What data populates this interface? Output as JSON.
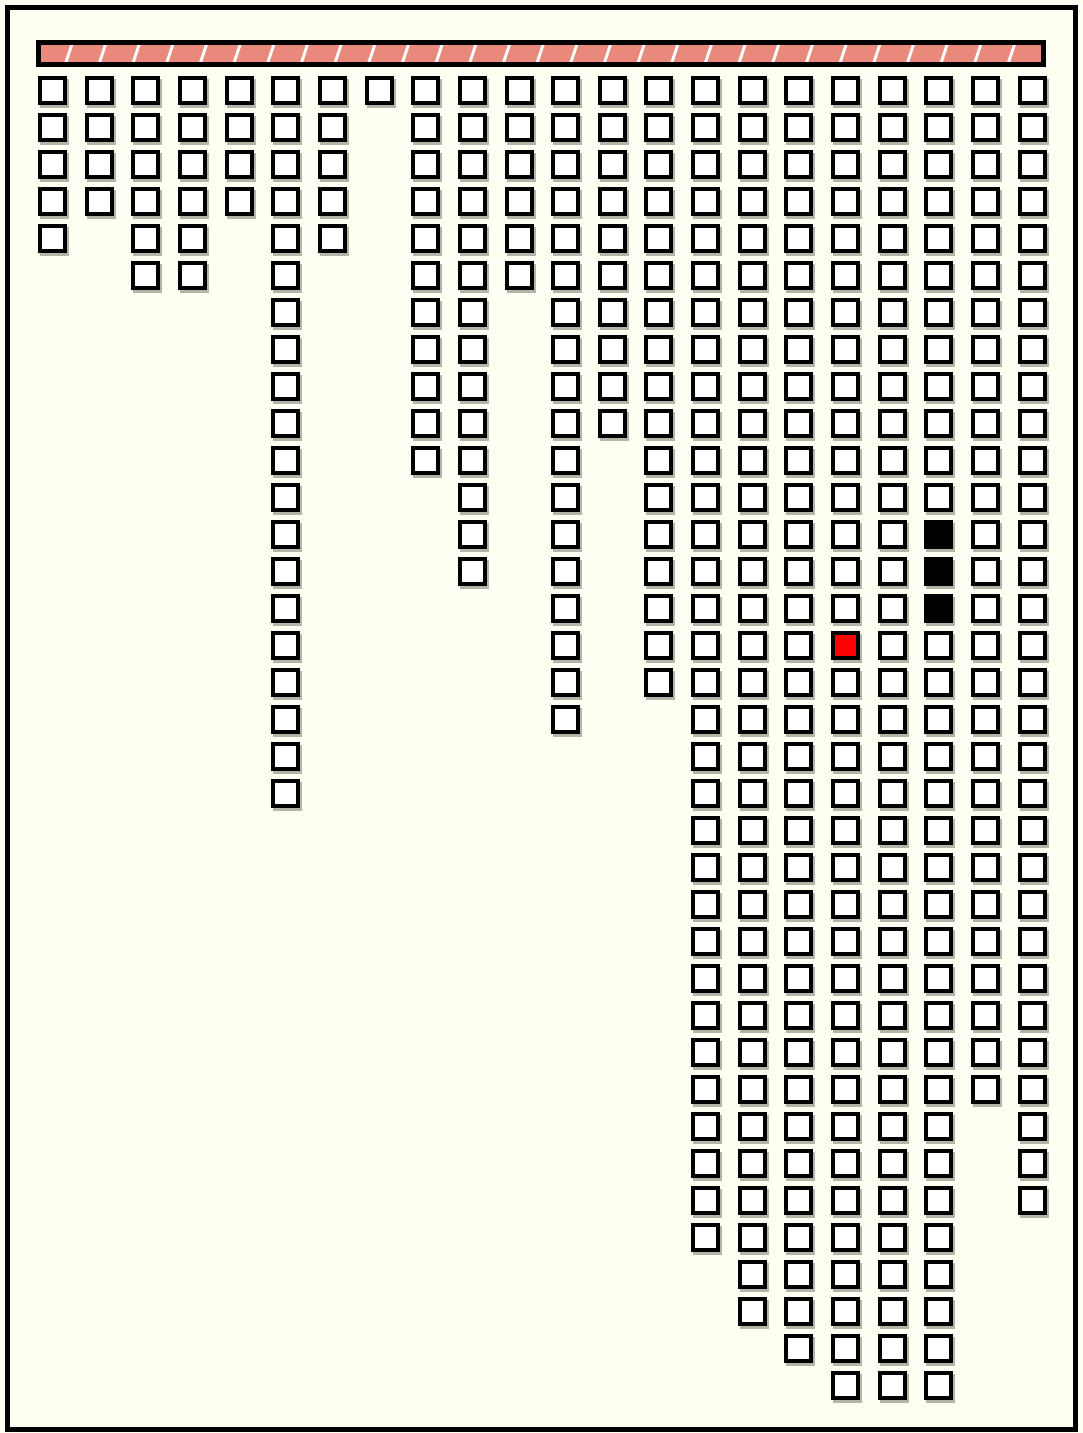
{
  "figure": {
    "kind": "hanging-chains-diagram",
    "width_px": 1083,
    "height_px": 1433,
    "background_color": "#FFFEF2",
    "frame_color": "#000000",
    "frame_inset_px": 5,
    "frame_thickness_px": 5
  },
  "support_bar": {
    "x": 36,
    "y": 40,
    "width": 1010,
    "height": 27,
    "fill_color": "#E8897B",
    "stripe_color": "#FFFFFF",
    "border_color": "#000000",
    "border_thickness": 5,
    "stripe_count": 30,
    "stripe_slant_px": 8
  },
  "grid": {
    "column_count": 22,
    "row_capacity": 36,
    "first_col_x": 38,
    "first_row_y": 76,
    "col_pitch": 46.65,
    "row_pitch": 37.0,
    "cell_size": 29,
    "cell_fill": "#FFFFFF",
    "cell_border_color": "#000000",
    "cell_shadow_color": "rgba(105,105,95,0.5)",
    "column_lengths": [
      5,
      4,
      6,
      6,
      4,
      20,
      5,
      1,
      11,
      14,
      6,
      18,
      10,
      17,
      32,
      34,
      35,
      36,
      36,
      36,
      28,
      31
    ],
    "highlight_cells": [
      {
        "col": 19,
        "row": 12,
        "color": "#000000",
        "name": "black-cell"
      },
      {
        "col": 19,
        "row": 13,
        "color": "#000000",
        "name": "black-cell"
      },
      {
        "col": 19,
        "row": 14,
        "color": "#000000",
        "name": "black-cell"
      },
      {
        "col": 17,
        "row": 15,
        "color": "#FF0000",
        "name": "red-cell"
      }
    ]
  }
}
